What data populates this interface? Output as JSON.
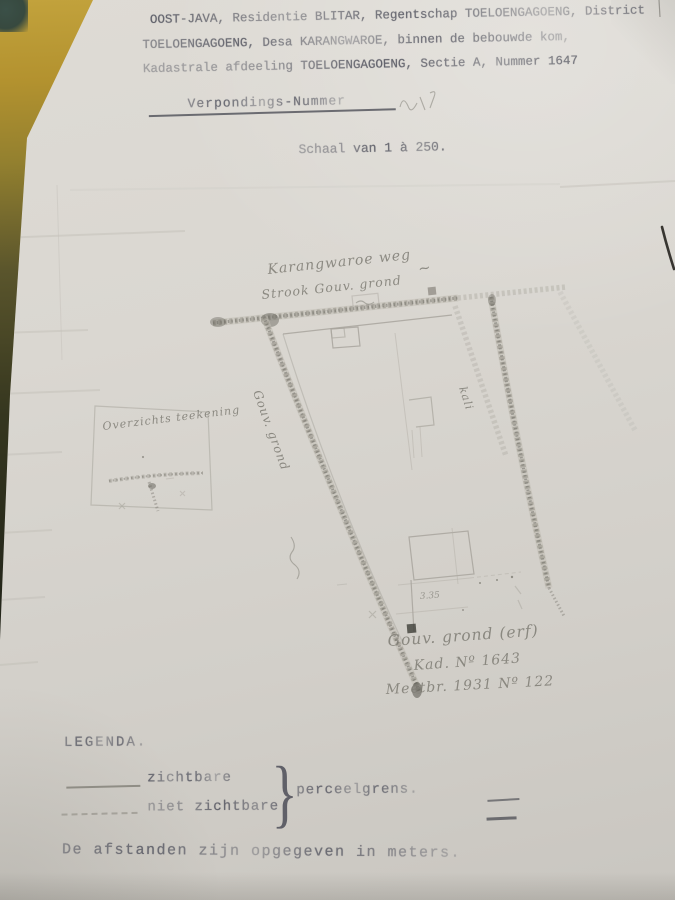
{
  "document": {
    "top_partial_line": "van het",
    "header_lines": [
      "OOST-JAVA, Residentie BLITAR, Regentschap TOELOENGAGOENG, District",
      "TOELOENGAGOENG, Desa KARANGWAROE, binnen de bebouwde kom,",
      "Kadastrale afdeeling TOELOENGAGOENG, Sectie A, Nummer 1647"
    ],
    "verponding_label": "Verpondings-Nummer",
    "scale_line": "Schaal van 1 à 250."
  },
  "map": {
    "labels": {
      "road_top": "Karangwaroe  weg",
      "strip_note": "Strook Gouv. grond",
      "left_boundary": "Gouv. grond",
      "watercourse": "kali",
      "tilde_mark": "~",
      "inset_title": "Overzichts teekening",
      "note_line1": "Gouv. grond (erf)",
      "note_line2": "Kad. Nº 1643",
      "note_line3": "Meetbr. 1931 Nº 122"
    },
    "measurements": {
      "bottom": "3.35"
    }
  },
  "legend": {
    "title": "LEGENDA.",
    "items": [
      {
        "style": "solid",
        "label": "zichtbare"
      },
      {
        "style": "dashed",
        "label": "niet zichtbare"
      }
    ],
    "brace_glyph": "}",
    "brace_label": "perceelgrens.",
    "footnote": "De afstanden zijn opgegeven in meters."
  },
  "colors": {
    "paper": "#d8d5cf",
    "typewriter_ink": "#5b5c66",
    "pencil": "#8b8982",
    "table_wood": "#b3922f"
  }
}
